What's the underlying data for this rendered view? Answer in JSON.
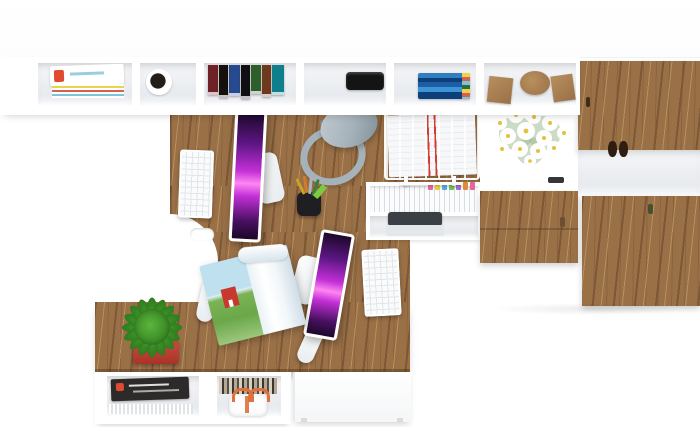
{
  "meta": {
    "description": "Top-down 3D render of a white and walnut home-office: wall shelf with magazines, mug, books, speaker and wooden decor; walnut cabinets with daisy bouquet; L-shaped walnut desk with two white monitors showing purple wallpaper, two white keyboards and mice, gray desk lamp, pen cup, wire paper tray, file folders, printer, open magazine; side table with cactus in red pot over a shelf with magazines and a white bag with orange handles; white drawer pedestal",
    "width": 700,
    "height": 427
  },
  "objects": [
    "wall shelf with open compartments",
    "stack of magazines",
    "white mug with dark interior",
    "row of colored books",
    "black portable speaker",
    "stack of blue books",
    "wooden decor blocks cube disc cube",
    "white daisy bouquet",
    "walnut cabinet doors with small handles",
    "small dark figurine in cubby",
    "walnut drawer fronts",
    "L-shaped walnut desk with curved cutout and cable grommet",
    "white monitor with purple abstract wallpaper workstation 1",
    "white monitor with purple abstract wallpaper workstation 2",
    "white keyboard workstation 1",
    "white keyboard workstation 2",
    "white mouse workstation 1",
    "white mouse workstation 2",
    "gray desk lamp",
    "black pen cup with pencils and green highlighter",
    "white wire paper tray with documents",
    "hanging file folders with colored tabs",
    "printer in white cubby",
    "open magazine with red house landscape photo",
    "green spiky cactus in red pot",
    "lower shelf with magazine stack and striped books",
    "white gift bag with orange handles",
    "white drawer pedestal on floor"
  ],
  "colors": {
    "floor": "#ffffff",
    "furniture_white": "#ffffff",
    "interior_light": "#f6f7f9",
    "interior_shade": "#e7eaee",
    "wood": "#9a7047",
    "wood_dark": "#7c5836",
    "wood_light": "#b88f5e",
    "wood_edge": "#6f4e2f",
    "screen_top": "#1c0829",
    "screen_violet": "#5c1683",
    "screen_magenta": "#c32fd6",
    "screen_pink": "#ff86f2",
    "screen_deep": "#471060",
    "lamp_gray": "#a5b2ba",
    "lamp_gray_dark": "#7e8d96",
    "lamp_gray_light": "#c3ccd1",
    "pot_red": "#c0453a",
    "pot_red_dark": "#a93327",
    "cactus_green": "#46a02e",
    "cactus_dark": "#2f7c1e",
    "cactus_light": "#5cb53c",
    "bag_orange": "#e0713a",
    "mug_black": "#241e19",
    "stripe_red": "#d23c34",
    "device_black": "#141414",
    "printer_dark": "#3b4046",
    "keyboard_key": "#e3e6e9",
    "spine_1": "#6e2126",
    "spine_2": "#15100c",
    "spine_3": "#274a8f",
    "spine_4": "#0f0f14",
    "spine_5": "#2e5e2a",
    "spine_6": "#6e3a1f",
    "spine_7": "#0f7f8c",
    "dvd_1": "#2f7fc1",
    "dvd_2": "#1b5ea6",
    "dvd_3": "#3e94d4",
    "dvd_4": "#0d3f7a",
    "tab_1": "#e2679b",
    "tab_2": "#e8c93e",
    "tab_3": "#58a8d8",
    "tab_4": "#6fbf5a",
    "tab_5": "#9d6fc4",
    "tab_6": "#e08a3c",
    "mag_edge_1": "#e8d44d",
    "mag_edge_2": "#d8604f",
    "mag_edge_3": "#7ec3d8",
    "mag_red": "#e04a30",
    "daisy_white": "#ffffff",
    "daisy_yellow": "#e3c23a",
    "daisy_leaf": "#9ab88e",
    "cover_dark": "#2d2b29",
    "house_red": "#c6392c",
    "sky_blue": "#bfe0ef",
    "field_green": "#7bb254"
  }
}
